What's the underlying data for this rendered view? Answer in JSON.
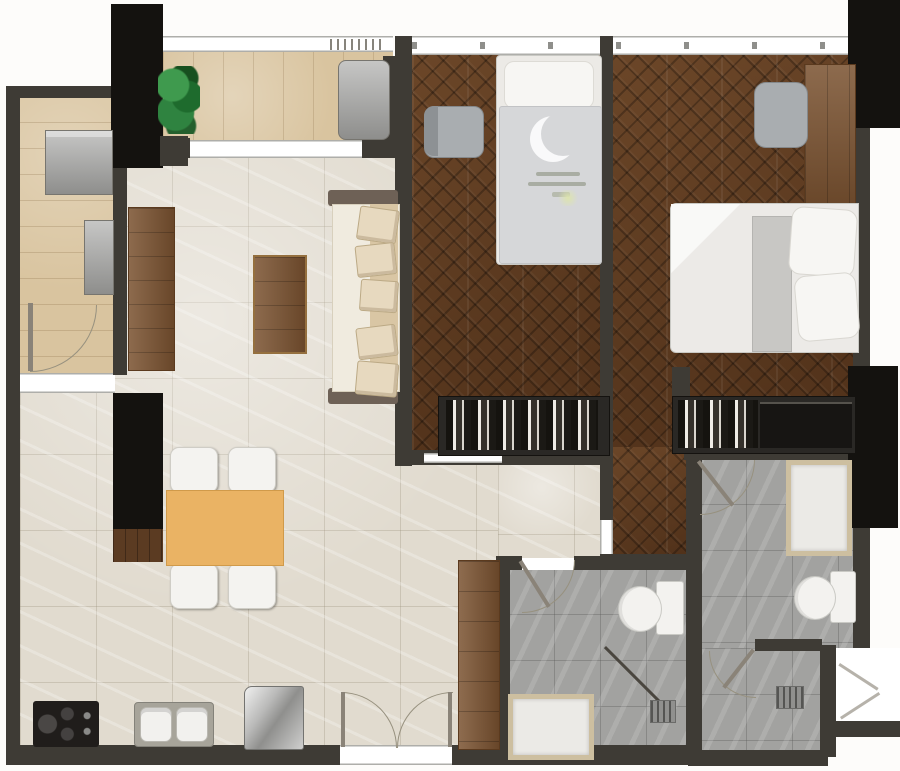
{
  "title": "Two-bedroom apartment floor plan (top view render)",
  "palette": {
    "wall": "#3e3b35",
    "slab": "#14120f",
    "tile": "#e1dbcf",
    "deck": "#d9c49f",
    "parquet": "#5f3d26",
    "grayTile": "#a2a2a0",
    "wood": "#7a5230",
    "woodDark": "#5b3b22",
    "orange": "#eab364",
    "fixtureWhite": "#f3f2ef",
    "matBorder": "#cdbfa0",
    "plantGreen": "#2f7c3c",
    "duvet": "#d6d7d9",
    "arcColor": "#97917f"
  },
  "rooms": {
    "living": {
      "label": "Living / Dining Room"
    },
    "kitchen": {
      "label": "Kitchen"
    },
    "hallway": {
      "label": "Hallway"
    },
    "bedroom1": {
      "label": "Bedroom 1"
    },
    "master": {
      "label": "Master Bedroom"
    },
    "nook": {
      "label": "Master Bedroom Entry"
    },
    "balconyTop": {
      "label": "Balcony"
    },
    "balconySide": {
      "label": "Utility Balcony"
    },
    "bathroom": {
      "label": "Common Bathroom"
    },
    "ensuite": {
      "label": "En-suite Bathroom"
    },
    "entrance": {
      "label": "Main Entrance"
    },
    "notch": {
      "label": "Service Notch"
    }
  },
  "furniture": {
    "sofa": "Sofa with pillows",
    "coffeeTable": "Coffee table",
    "tvConsole": "TV console",
    "diningTable": "Dining table",
    "diningChair": "Dining chair",
    "cooktop": "Cooktop",
    "sink": "Double kitchen sink",
    "fridge": "Refrigerator",
    "tallCabinet": "Tall cabinet",
    "washer": "Washing machine",
    "acUnit": "Condenser unit",
    "plant": "Potted plant",
    "lounge": "Balcony unit",
    "bed1": "Single bed",
    "deskChair": "Desk chair",
    "wardrobe": "Wardrobe with hanging clothes",
    "masterBed": "Double bed",
    "masterDesk": "Desk / dresser",
    "tvUnit": "TV unit",
    "toilet": "Toilet",
    "showerTray": "Shower tray",
    "showerMat": "Shower mat",
    "floorDrain": "Floor drain",
    "entryDoor": "Double entrance door",
    "door": "Door swing",
    "window": "Window",
    "slidingDoor": "Sliding door"
  }
}
